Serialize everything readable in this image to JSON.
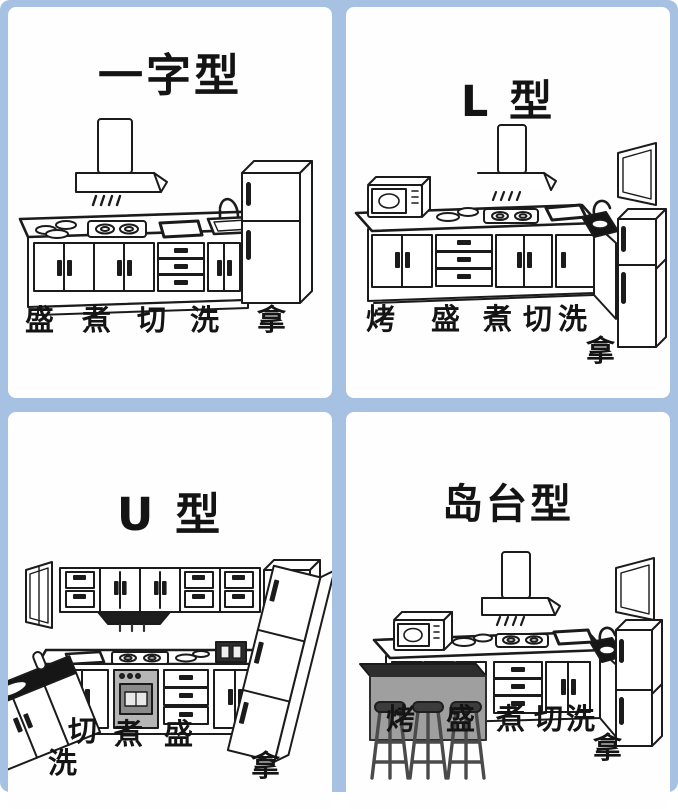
{
  "frame": {
    "border_color": "#a6c1e1",
    "panel_background": "#fefefe",
    "line_art_color": "#1b1b1b",
    "island_top_color": "#2d2d2d",
    "island_body_color": "#9f9f9f",
    "oven_color": "#b5b5b5"
  },
  "panels": [
    {
      "id": "linear",
      "title": "一字型",
      "labels": [
        "盛",
        "煮",
        "切",
        "洗",
        "拿"
      ]
    },
    {
      "id": "l-type",
      "title": "L 型",
      "labels": [
        "烤",
        "盛",
        "煮",
        "切",
        "洗",
        "拿"
      ]
    },
    {
      "id": "u-type",
      "title": "U 型",
      "labels": [
        "切",
        "煮",
        "盛",
        "洗",
        "拿"
      ]
    },
    {
      "id": "island",
      "title": "岛台型",
      "labels": [
        "烤",
        "盛",
        "煮",
        "切",
        "洗",
        "拿"
      ]
    }
  ]
}
